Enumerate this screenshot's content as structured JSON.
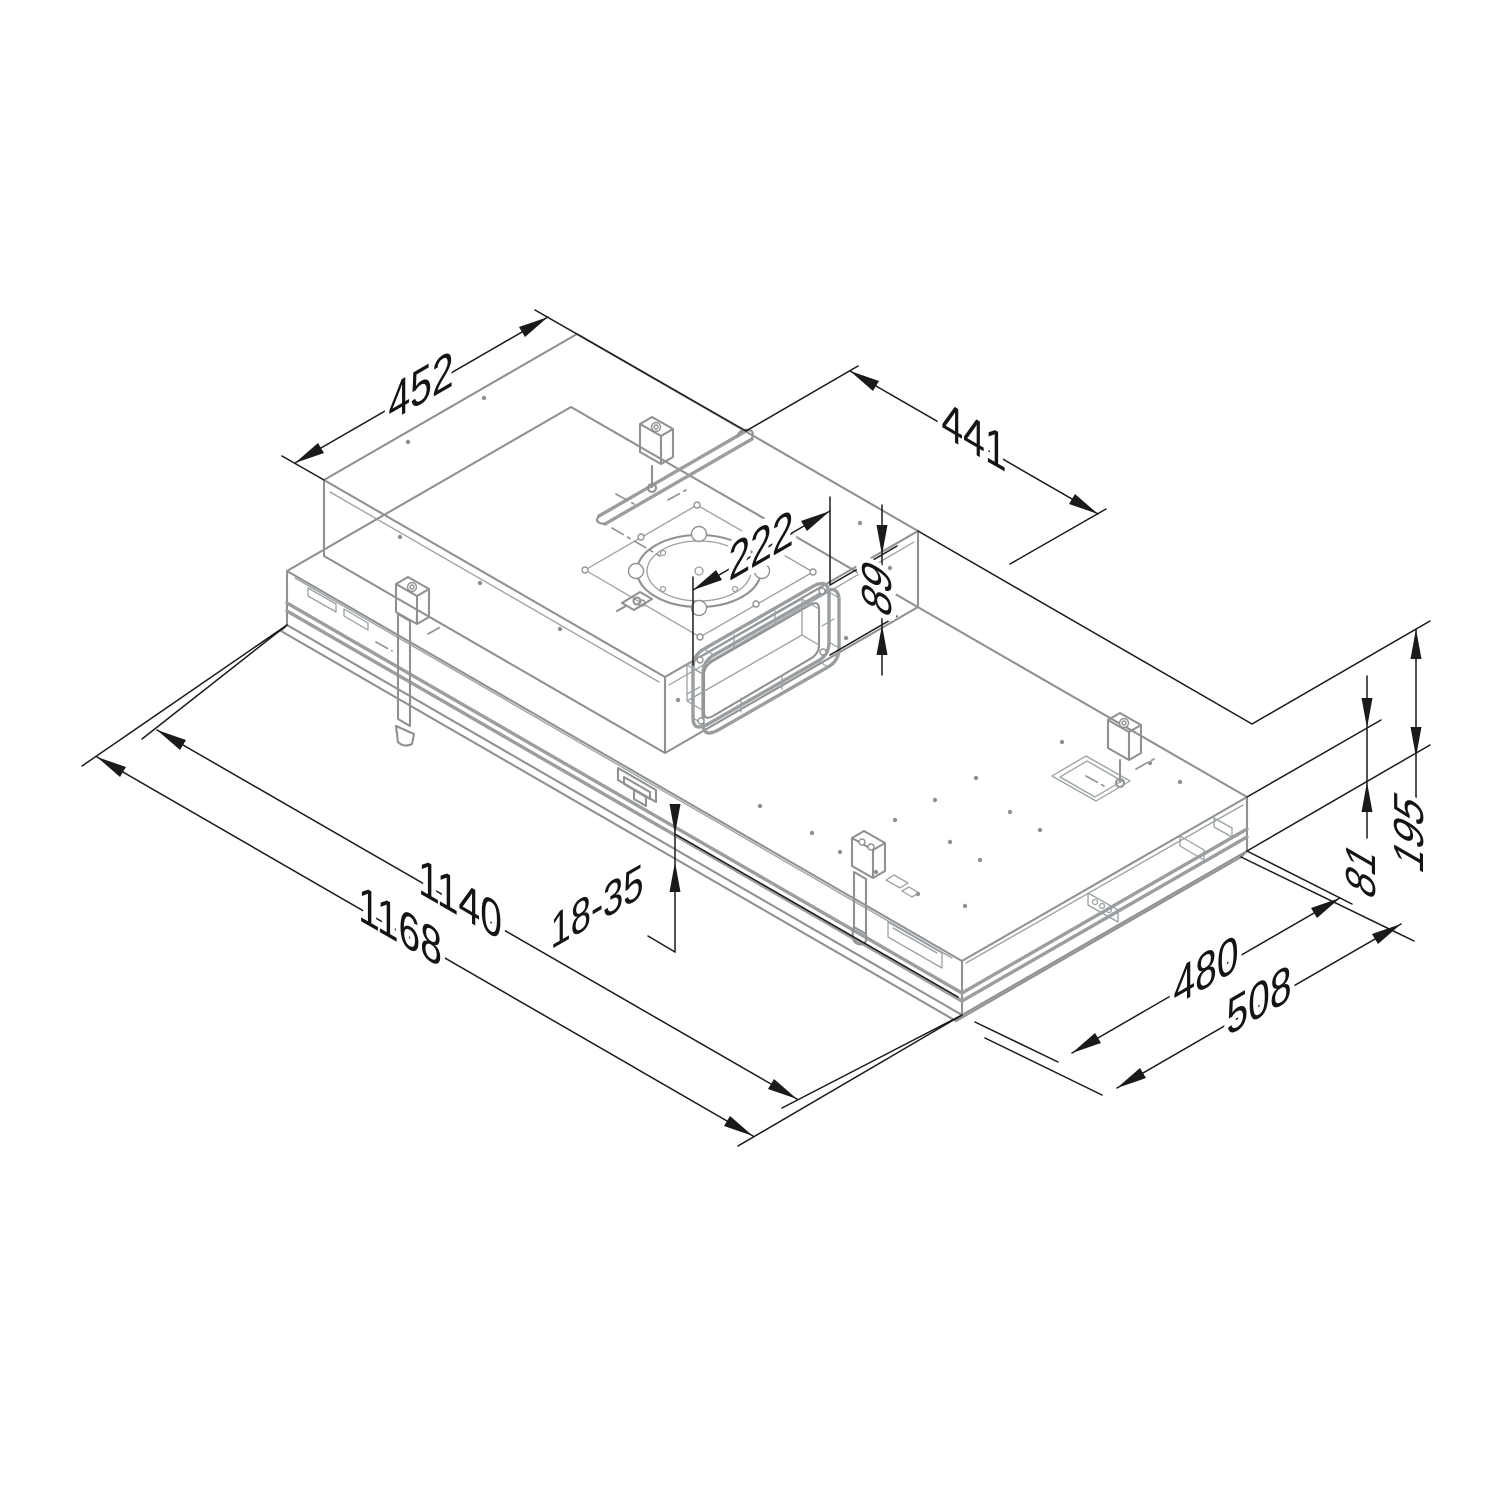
{
  "canvas": {
    "width": 1500,
    "height": 1502,
    "background": "#ffffff"
  },
  "diagram": {
    "type": "isometric_dimensioned_drawing",
    "subject": "built-in ceiling extractor hood unit — installation dimension drawing",
    "units": "mm",
    "colors": {
      "body_line": "#8f9193",
      "body_line_light": "#9aa0a3",
      "dimension_line": "#1a1a1a",
      "background": "#ffffff"
    },
    "dims": {
      "top_depth": "452",
      "top_length": "441",
      "duct_width": "222",
      "duct_height": "89",
      "ceiling_thickness_range": "18-35",
      "cutout_length": "1140",
      "overall_length": "1168",
      "cutout_depth": "480",
      "overall_depth": "508",
      "body_height": "81",
      "overall_height": "195"
    }
  }
}
